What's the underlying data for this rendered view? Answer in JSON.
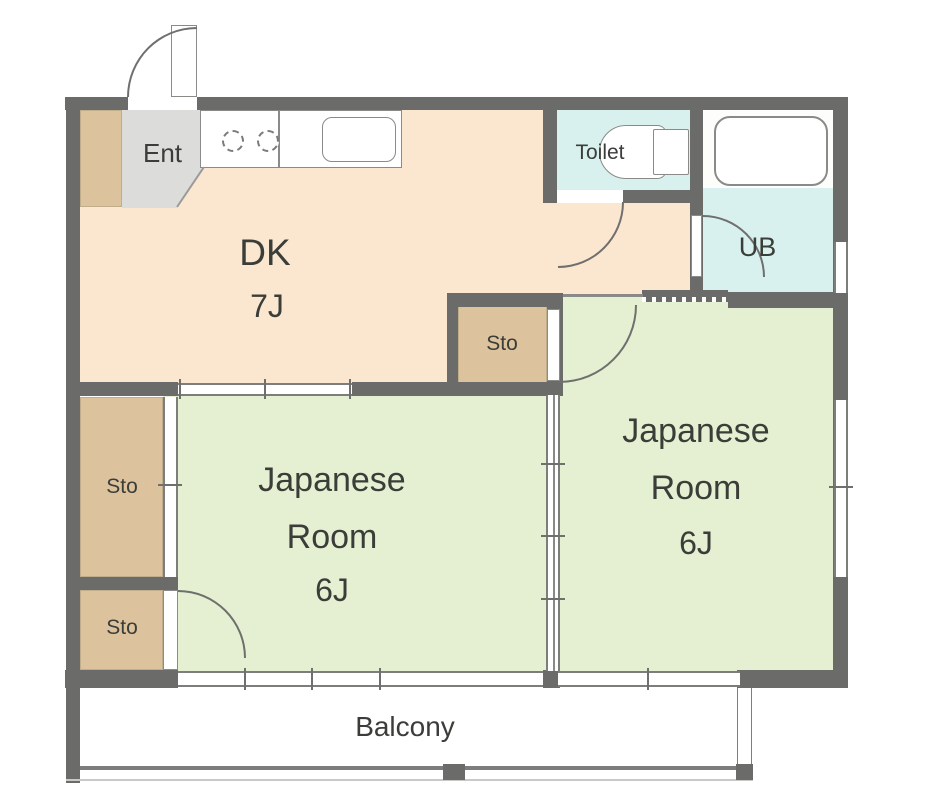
{
  "colors": {
    "wall": "#6b6b69",
    "line": "#8a8a88",
    "arc": "#6f6f6d",
    "frame": "#7d7d7b",
    "dk": "#fbe7d0",
    "tatami": "#e4f0d1",
    "storage": "#dcc29d",
    "entry": "#dcdcda",
    "wet": "#d8f1ee",
    "text": "#3b3d38"
  },
  "rooms": {
    "entrance": {
      "label": "Ent"
    },
    "dining_kitchen": {
      "label": "DK",
      "size": "7J"
    },
    "toilet": {
      "label": "Toilet"
    },
    "unit_bath": {
      "label": "UB"
    },
    "storage_mid": {
      "label": "Sto"
    },
    "storage_upper": {
      "label": "Sto"
    },
    "storage_lower": {
      "label": "Sto"
    },
    "japanese_room_left": {
      "label": "Japanese Room",
      "size": "6J"
    },
    "japanese_room_right": {
      "label": "Japanese Room",
      "size": "6J"
    },
    "balcony": {
      "label": "Balcony"
    }
  }
}
